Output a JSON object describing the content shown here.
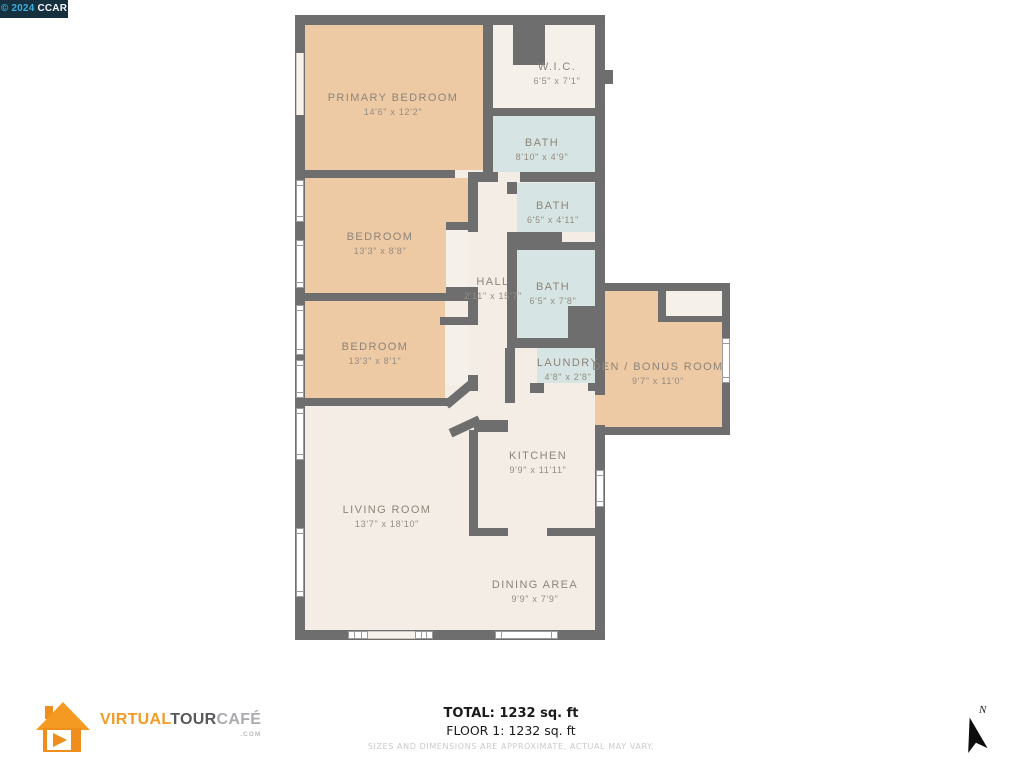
{
  "badge": {
    "copyright": "© 2024",
    "org": "CCAR"
  },
  "plan": {
    "rooms": [
      {
        "name": "PRIMARY BEDROOM",
        "dims": "14'6\" x 12'2\""
      },
      {
        "name": "W.I.C.",
        "dims": "6'5\" x 7'1\""
      },
      {
        "name": "BATH",
        "dims": "8'10\" x 4'9\""
      },
      {
        "name": "BEDROOM",
        "dims": "13'3\" x 8'8\""
      },
      {
        "name": "BATH",
        "dims": "6'5\" x 4'11\""
      },
      {
        "name": "HALL",
        "dims": "2'11\" x 15'7\""
      },
      {
        "name": "BATH",
        "dims": "6'5\" x 7'8\""
      },
      {
        "name": "BEDROOM",
        "dims": "13'3\" x 8'1\""
      },
      {
        "name": "LAUNDRY",
        "dims": "4'8\" x 2'8\""
      },
      {
        "name": "DEN / BONUS ROOM",
        "dims": "9'7\" x 11'0\""
      },
      {
        "name": "KITCHEN",
        "dims": "9'9\" x 11'11\""
      },
      {
        "name": "LIVING ROOM",
        "dims": "13'7\" x 18'10\""
      },
      {
        "name": "DINING AREA",
        "dims": "9'9\" x 7'9\""
      }
    ]
  },
  "footer": {
    "logo": {
      "part1": "VIRTUAL",
      "part2": "TOUR",
      "part3": "CAFÉ",
      "tld": ".COM"
    },
    "total": "TOTAL: 1232 sq. ft",
    "floor": "FLOOR 1: 1232 sq. ft",
    "disclaimer": "SIZES AND DIMENSIONS ARE APPROXIMATE, ACTUAL MAY VARY."
  },
  "compass": {
    "label": "N"
  },
  "colors": {
    "wall": "#6e6e6e",
    "bedroom_fill": "#edc9a4",
    "bath_fill": "#d6e4e3",
    "floor_fill": "#f4ede5",
    "closet_fill": "#f6f0ea",
    "logo_orange": "#f39b26",
    "badge_bg": "#16303f",
    "badge_accent": "#38b0dd"
  }
}
